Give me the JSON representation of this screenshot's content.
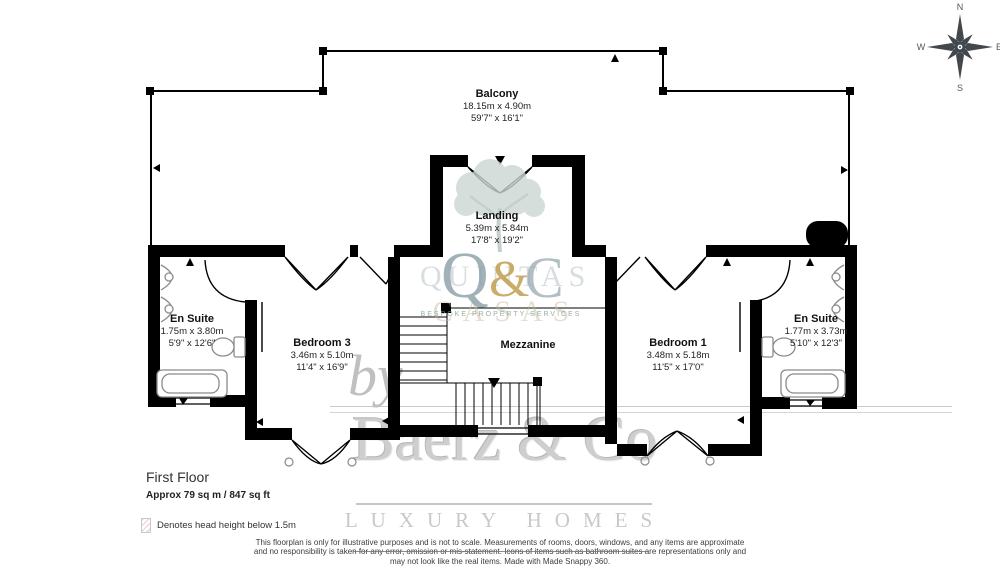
{
  "title": {
    "floor": "First Floor",
    "area": "Approx 79 sq m / 847 sq ft"
  },
  "legend": {
    "text": "Denotes head height below 1.5m"
  },
  "compass": {
    "n": "N",
    "e": "E",
    "s": "S",
    "w": "W"
  },
  "rooms": {
    "balcony": {
      "name": "Balcony",
      "metric": "18.15m x 4.90m",
      "imperial": "59'7\" x 16'1\""
    },
    "landing": {
      "name": "Landing",
      "metric": "5.39m x 5.84m",
      "imperial": "17'8\" x 19'2\""
    },
    "ensuite_left": {
      "name": "En Suite",
      "metric": "1.75m x 3.80m",
      "imperial": "5'9\" x 12'6\""
    },
    "bedroom3": {
      "name": "Bedroom 3",
      "metric": "3.46m x 5.10m",
      "imperial": "11'4\" x 16'9\""
    },
    "mezzanine": {
      "name": "Mezzanine"
    },
    "bedroom1": {
      "name": "Bedroom 1",
      "metric": "3.48m x 5.18m",
      "imperial": "11'5\" x 17'0\""
    },
    "ensuite_right": {
      "name": "En Suite",
      "metric": "1.77m x 3.73m",
      "imperial": "5'10\" x 12'3\""
    }
  },
  "watermark": {
    "by": "by",
    "brand": "Baerz & Co",
    "tagline": "LUXURY HOMES",
    "logo_q": "Q",
    "logo_amp": "&",
    "logo_c": "C",
    "logo_line1": "QUINTAS",
    "logo_line2": "CASAS",
    "logo_sub": "BESPOKE PROPERTY SERVICES"
  },
  "footer": {
    "line1": "This floorplan is only for illustrative purposes and is not to scale. Measurements of rooms, doors, windows, and any items are approximate",
    "line2": "and no responsibility is taken for any error, omission or mis-statement. Icons of items such as bathroom suites are representations only and",
    "line3": "may not look like the real items. Made with Made Snappy 360."
  },
  "colors": {
    "wall": "#000000",
    "fixture_outline": "#8a8a8a",
    "watermark_gray": "#c9c9c9",
    "logo_gold": "#ba943c",
    "logo_blue_gray": "#8da3ad",
    "tree_green": "#ccd7d3"
  },
  "icons": {
    "compass": "compass-rose",
    "tree": "deciduous-tree",
    "stairs_arrow": "down-triangle",
    "head_height_swatch": "hatched-square"
  }
}
